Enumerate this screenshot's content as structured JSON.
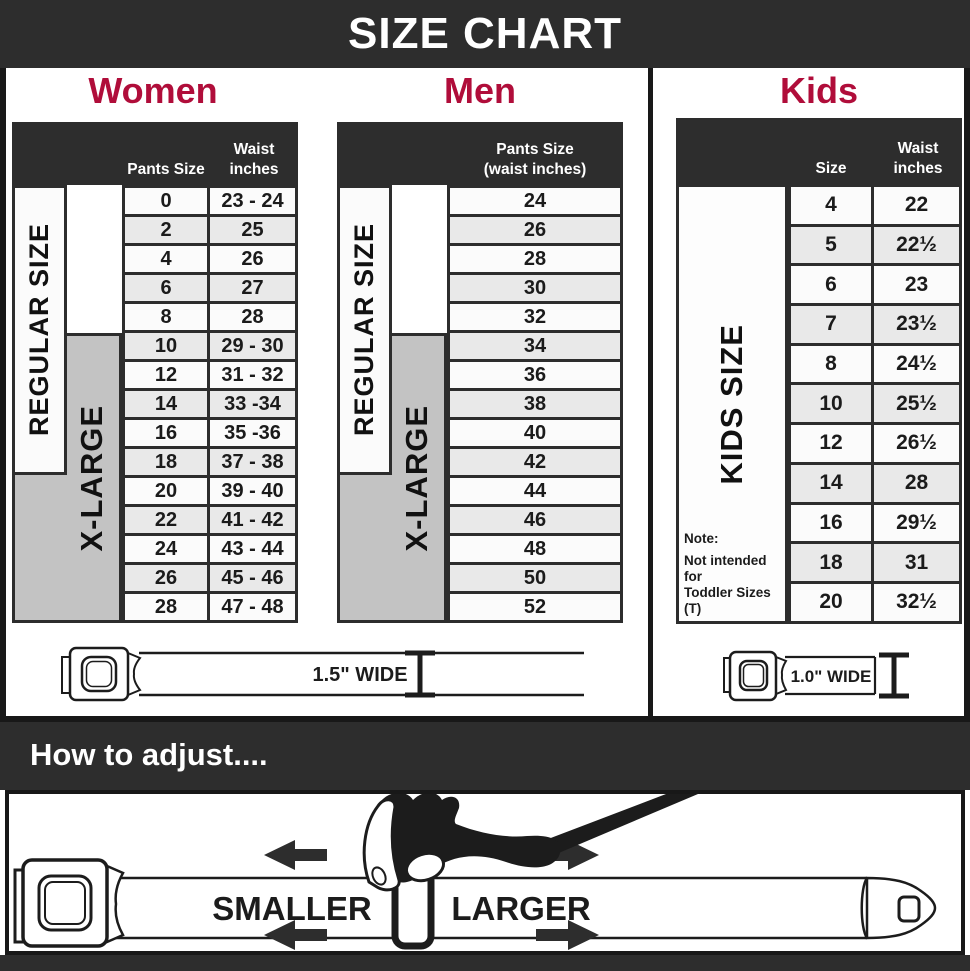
{
  "title_bar": {
    "title": "SIZE CHART"
  },
  "colors": {
    "bar_dark": "#2d2d2d",
    "accent_red": "#b00d3a",
    "xlarge_gray": "#c3c3c3",
    "border_dark": "#181818"
  },
  "women": {
    "heading": "Women",
    "header": {
      "pants": "Pants Size",
      "waist": "Waist\ninches"
    },
    "regular_label": "REGULAR SIZE",
    "xlarge_label": "X-LARGE",
    "rows": [
      [
        "0",
        "23 - 24"
      ],
      [
        "2",
        "25"
      ],
      [
        "4",
        "26"
      ],
      [
        "6",
        "27"
      ],
      [
        "8",
        "28"
      ],
      [
        "10",
        "29 - 30"
      ],
      [
        "12",
        "31 - 32"
      ],
      [
        "14",
        "33 -34"
      ],
      [
        "16",
        "35 -36"
      ],
      [
        "18",
        "37 - 38"
      ],
      [
        "20",
        "39 - 40"
      ],
      [
        "22",
        "41 - 42"
      ],
      [
        "24",
        "43 - 44"
      ],
      [
        "26",
        "45 - 46"
      ],
      [
        "28",
        "47 - 48"
      ]
    ]
  },
  "men": {
    "heading": "Men",
    "header": {
      "pants": "Pants Size\n(waist inches)"
    },
    "regular_label": "REGULAR SIZE",
    "xlarge_label": "X-LARGE",
    "rows": [
      "24",
      "26",
      "28",
      "30",
      "32",
      "34",
      "36",
      "38",
      "40",
      "42",
      "44",
      "46",
      "48",
      "50",
      "52"
    ]
  },
  "kids": {
    "heading": "Kids",
    "header": {
      "size": "Size",
      "waist": "Waist\ninches"
    },
    "side_label": "KIDS SIZE",
    "note": {
      "line1": "Note:",
      "line2": "Not intended for",
      "line3": "Toddler Sizes (T)"
    },
    "rows": [
      [
        "4",
        "22"
      ],
      [
        "5",
        "22½"
      ],
      [
        "6",
        "23"
      ],
      [
        "7",
        "23½"
      ],
      [
        "8",
        "24½"
      ],
      [
        "10",
        "25½"
      ],
      [
        "12",
        "26½"
      ],
      [
        "14",
        "28"
      ],
      [
        "16",
        "29½"
      ],
      [
        "18",
        "31"
      ],
      [
        "20",
        "32½"
      ]
    ]
  },
  "belts": {
    "adult": {
      "label": "1.5\" WIDE"
    },
    "kids": {
      "label": "1.0\" WIDE"
    }
  },
  "adjust": {
    "heading": "How to adjust....",
    "smaller": "SMALLER",
    "larger": "LARGER"
  }
}
